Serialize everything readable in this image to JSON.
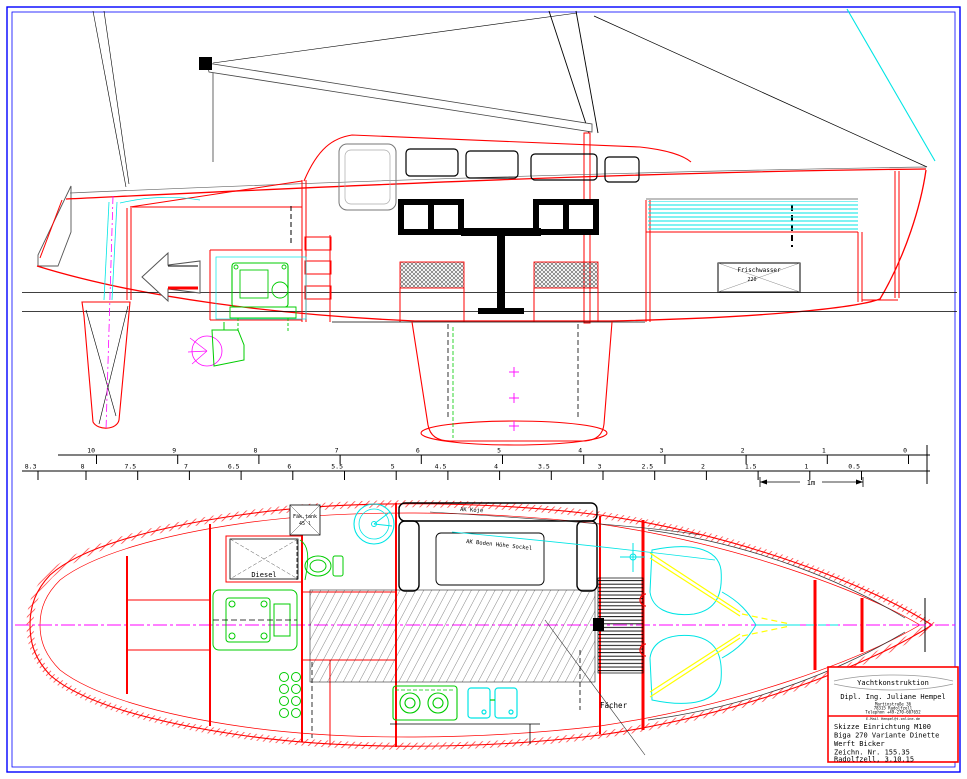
{
  "drawing": {
    "labels": {
      "frischwasser": "Frischwasser",
      "frischwasser_volume": "220",
      "diesel": "Diesel",
      "faek_tank": "Fäk.tank",
      "faek_volume": "45 l",
      "ak_koje": "AK Koje",
      "ak_boden": "AK Boden Höhe Sockel",
      "faecher": "Fächer"
    },
    "colors": {
      "outline_red": "#ff0000",
      "border_blue": "#0000ff",
      "rigging_cyan": "#00ffff",
      "machinery_green": "#00cc00",
      "centerline_magenta": "#ff00ff",
      "accent_yellow": "#ffff00"
    }
  },
  "rulers": {
    "top": {
      "labels": [
        "10",
        "9",
        "8",
        "7",
        "6",
        "5",
        "4",
        "3",
        "2",
        "1",
        "0"
      ]
    },
    "bottom": {
      "labels": [
        "8.3",
        "8",
        "7.5",
        "7",
        "6.5",
        "6",
        "5.5",
        "5",
        "4.5",
        "4",
        "3.5",
        "3",
        "2.5",
        "2",
        "1.5",
        "1",
        "0.5"
      ]
    },
    "one_meter": "1m"
  },
  "title_block": {
    "company": "Yachtkonstruktion",
    "designer": "Dipl. Ing. Juliane Hempel",
    "address_lines": [
      "Martinstraße 36",
      "78315 Radolfzell",
      "Telephon +49-270-607652"
    ],
    "email_line": "E-Mail Hempel@t-online.de",
    "project_lines": [
      "Skizze Einrichtung M100",
      "Biga 270 Variante Dinette",
      "Werft Bicker",
      "Zeichn. Nr. 155.35",
      "Radolfzell, 3.10.15"
    ]
  }
}
